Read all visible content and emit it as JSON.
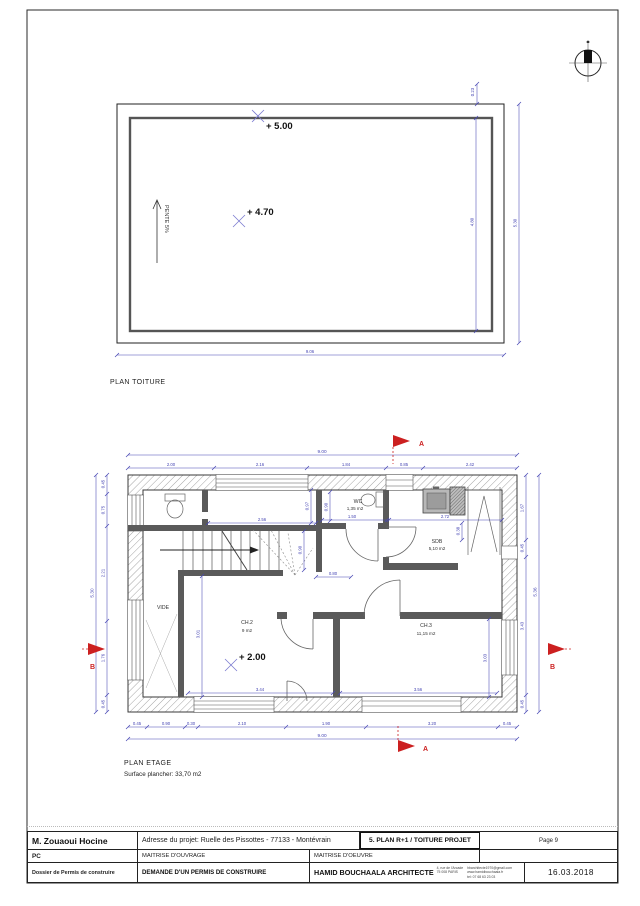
{
  "roof": {
    "title": "PLAN TOITURE",
    "level_ridge": "+ 5.00",
    "level_mid": "+ 4.70",
    "slope": "PENTE 5%",
    "dim_edge": "0.23",
    "dim_inner_h": "4.80",
    "dim_outer_h": "5.30",
    "dim_width": "9.06"
  },
  "floor": {
    "title": "PLAN ETAGE",
    "surface": "Surface plancher: 33,70 m2",
    "level": "+ 2.00",
    "rooms": {
      "wc": "WC",
      "wc_area": "1,35 m2",
      "sdb": "SDB",
      "sdb_area": "5,10 m2",
      "ch2": "CH.2",
      "ch2_area": "9 m2",
      "ch3": "CH.3",
      "ch3_area": "11,15 m2",
      "vide": "VIDE"
    },
    "dim": {
      "top_total": "9.00",
      "top": [
        "2.00",
        "2.16",
        "1.84",
        "0.85",
        "2.42"
      ],
      "bottom": [
        "0.45",
        "0.90",
        "0.30",
        "2.10",
        "1.90",
        "3.20",
        "0.45"
      ],
      "bottom_total": "9.00",
      "left": [
        "0.45",
        "0.75",
        "2.21",
        "1.76",
        "0.45"
      ],
      "left_total": "5.30",
      "right": [
        "1.67",
        "0.45",
        "3.43",
        "0.45"
      ],
      "right_total": "5.36",
      "hall_width": "2.56",
      "corridor": "0.97",
      "wc_depth": "0.90",
      "wc_width": "1.50",
      "sdb_width": "2.72",
      "sdb_recess": "0.38",
      "stair_width": "0.90",
      "stair_run": "0.80",
      "ch2_depth": "3.01",
      "ch3_depth": "3.03",
      "ch2_width": "3.44",
      "ch3_width": "3.56"
    },
    "section_a": "A",
    "section_b": "B"
  },
  "tb": {
    "client": "M. Zouaoui Hocine",
    "address": "Adresse du projet: Ruelle des Pissottes - 77133 - Montévrain",
    "sheet_title": "5. PLAN R+1 / TOITURE PROJET",
    "page": "Page 9",
    "doc_code": "PC",
    "maitrise_ouvrage": "MAITRISE D'OUVRAGE",
    "maitrise_oeuvre": "MAITRISE D'OEUVRE",
    "dossier": "Dossier de Permis de construire",
    "demande": "DEMANDE D'UN PERMIS DE CONSTRUIRE",
    "architect": "HAMID BOUCHAALA ARCHITECTE",
    "arch_addr1": "4, rue de l'Arcade",
    "arch_addr2": "75 008 PARIS",
    "arch_email": "hbarchitecte1970@gmail.com",
    "arch_web": "www.hamidbouchaala.fr",
    "arch_tel": "tel: 07 68 63 23 03",
    "date": "16.03.2018"
  }
}
